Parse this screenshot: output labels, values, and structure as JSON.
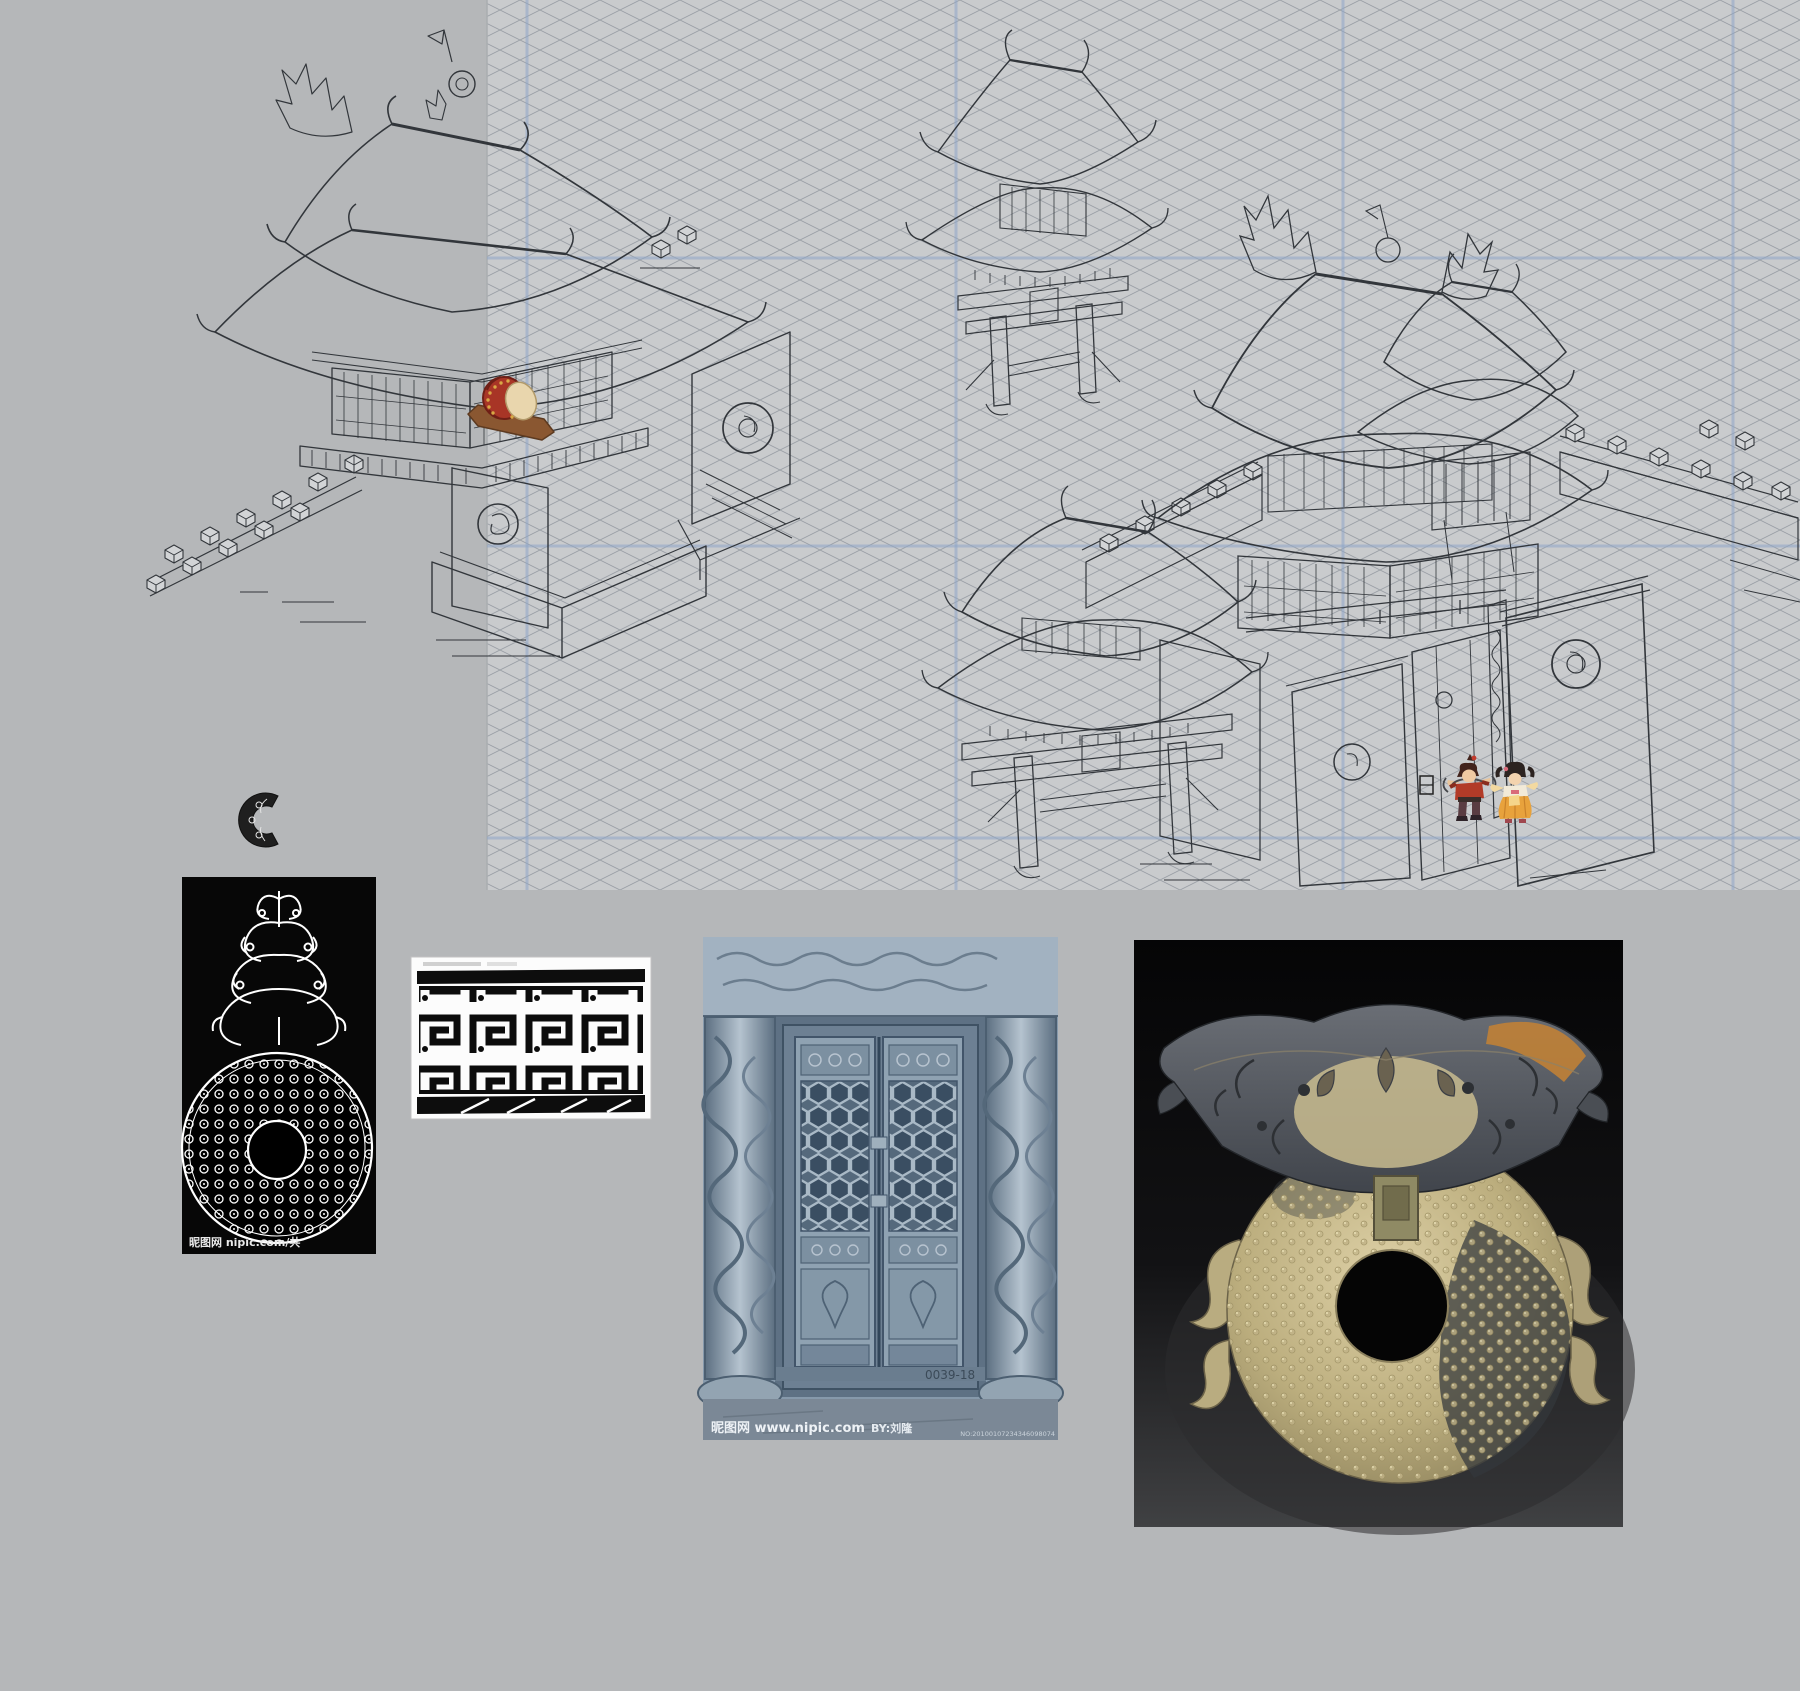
{
  "board": {
    "page_bg": "#b5b7b9",
    "sketch_area": {
      "x": 487,
      "y": 0,
      "w": 1313,
      "h": 890,
      "bg": "#c9cbcd",
      "hatch_color": "#9aa0a6",
      "grid_color": "#8fa6c9",
      "verticals": [
        527,
        956,
        1343,
        1733
      ],
      "horizontals": [
        258,
        546,
        838
      ]
    },
    "ink": "#32363b",
    "paper": "#d2d4d6"
  },
  "drum": {
    "body": "#a83526",
    "rim": "#6f1f16",
    "head": "#e9d6ad",
    "studs": "#d8a845",
    "stand": "#8a5731"
  },
  "sprites": {
    "warrior": {
      "outfit": "#b23b28",
      "hair": "#42231c"
    },
    "dancer": {
      "outfit": "#e8a23c",
      "hair": "#2c2320"
    }
  },
  "references": {
    "pendant_plate": {
      "watermark": "昵图网 nipic.com/共"
    },
    "door_photo": {
      "site_watermark": "昵图网 www.nipic.com",
      "by_watermark": "BY:刘隆",
      "serial": "NO:20100107234346098074",
      "plate_number": "0039-18",
      "tint": "#8699ab"
    },
    "jade_photo": {
      "jade_light": "#d8cba0",
      "jade_dark": "#4a4e54",
      "amber": "#c08136"
    }
  }
}
